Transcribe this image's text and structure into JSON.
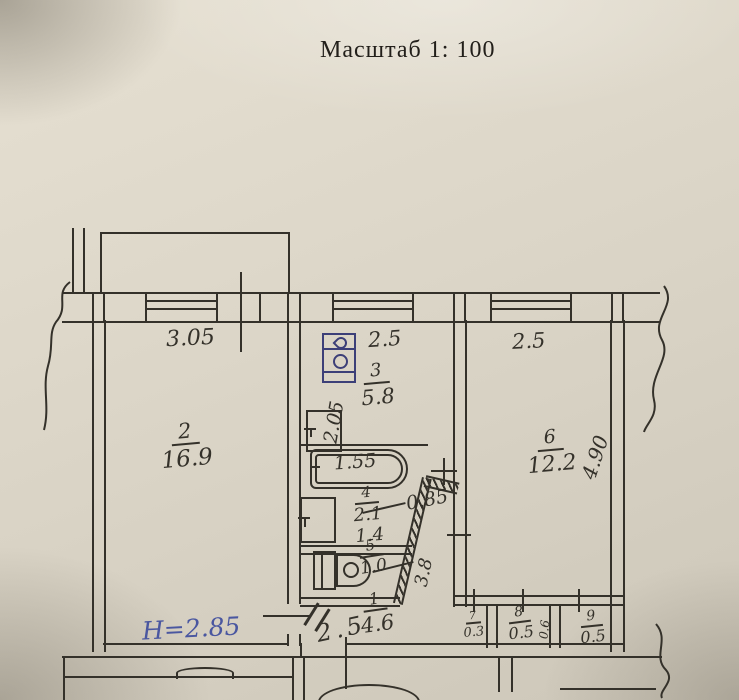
{
  "title": "Масштаб 1: 100",
  "note_blue": "Н=2.85",
  "colors": {
    "paper": "#d8d2c4",
    "ink": "#34312a",
    "pen_blue": "#4a57a0",
    "stove_ink": "#3c3f78"
  },
  "rooms": {
    "r1": {
      "num": "1",
      "area": "4.6"
    },
    "r2": {
      "num": "2",
      "area": "16.9"
    },
    "r3": {
      "num": "3",
      "area": "5.8"
    },
    "r4": {
      "num": "4",
      "area": "2.1",
      "area_extra": "1.4"
    },
    "r5": {
      "num": "5",
      "area": "1.0"
    },
    "r6": {
      "num": "6",
      "area": "12.2"
    },
    "r7": {
      "num": "7",
      "area": "0.3"
    },
    "r8": {
      "num": "8",
      "area": "0.5"
    },
    "r9": {
      "num": "9",
      "area": "0.5"
    }
  },
  "dims": {
    "room2_width": "3.05",
    "kitchen_width": "2.5",
    "room6_width": "2.5",
    "kitchen_depth": "2.05",
    "bathtub_len": "1.55",
    "hall_opening": "0.85",
    "hall_wall": "3.8",
    "room6_depth": "4.90",
    "hall_width": "2.5",
    "closet8_depth": "0.6"
  },
  "fixtures": [
    "stove-icon",
    "sink-icon",
    "bathtub-icon",
    "washbasin-icon",
    "toilet-icon"
  ]
}
